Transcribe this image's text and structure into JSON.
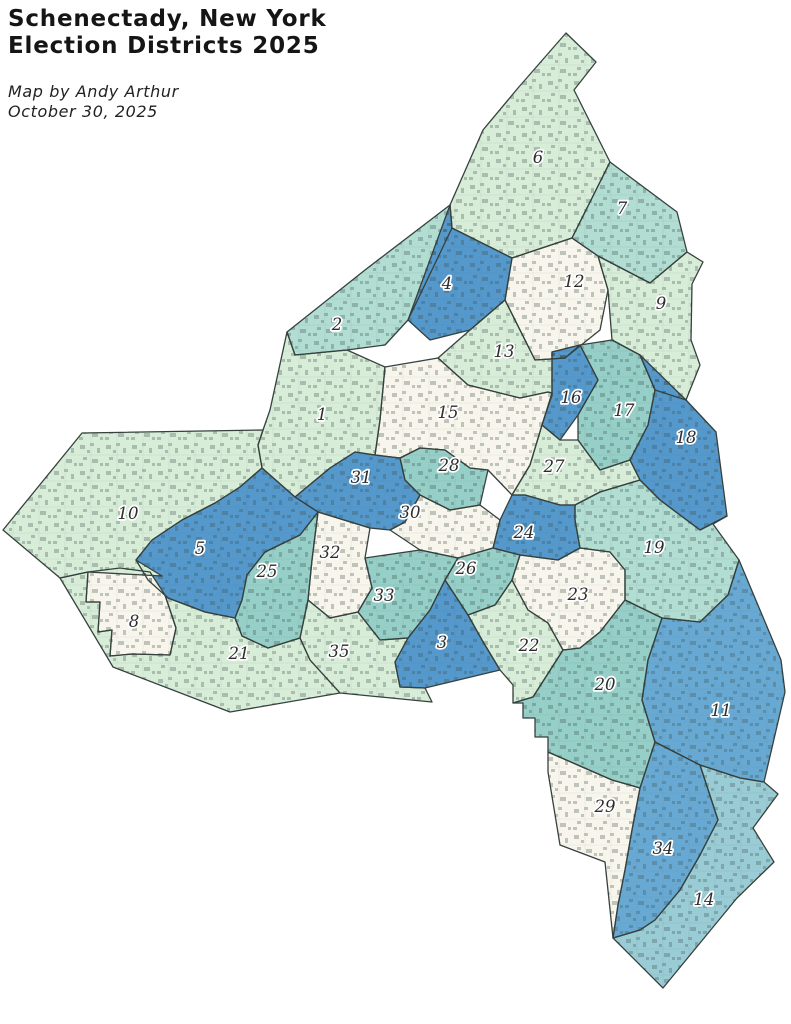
{
  "title": {
    "text": "Schenectady, New York\nElection Districts 2025"
  },
  "credit": {
    "text": "Map by Andy Arthur\nOctober 30, 2025"
  },
  "map": {
    "stroke_color": "#36413e",
    "building_mark_color": "#3c4f4b",
    "palette": {
      "pale_green": "#d7edd8",
      "teal_light": "#b2ddd2",
      "teal": "#96cfc7",
      "blue": "#5598cb",
      "blue_medium": "#68a9d3",
      "blue_pale": "#9accd6",
      "cream": "#f8f6ec"
    },
    "districts": [
      {
        "number": "1",
        "fill": "pale_green",
        "label_x": 322,
        "label_y": 414,
        "points": "263,430 270,410 287,332 295,355 347,350 385,367 380,420 375,455 355,452 330,468 295,497 262,468 258,445"
      },
      {
        "number": "2",
        "fill": "teal_light",
        "label_x": 337,
        "label_y": 324,
        "points": "365,270 450,205 452,228 408,320 385,345 347,350 295,355 287,332"
      },
      {
        "number": "3",
        "fill": "blue",
        "label_x": 442,
        "label_y": 642,
        "points": "445,580 468,615 482,640 500,670 425,688 400,687 395,662 408,638 430,610"
      },
      {
        "number": "4",
        "fill": "blue",
        "label_x": 447,
        "label_y": 283,
        "points": "450,205 452,228 512,258 505,300 470,330 430,340 408,320"
      },
      {
        "number": "5",
        "fill": "blue",
        "label_x": 200,
        "label_y": 548,
        "points": "262,468 295,497 318,512 300,535 265,552 247,575 242,600 235,618 205,612 168,598 148,580 136,560 152,540 182,520 215,503 240,487"
      },
      {
        "number": "6",
        "fill": "pale_green",
        "label_x": 538,
        "label_y": 157,
        "points": "566,33 596,62 574,90 610,162 572,238 512,258 452,228 450,205 483,130 518,88"
      },
      {
        "number": "7",
        "fill": "teal_light",
        "label_x": 622,
        "label_y": 208,
        "points": "610,162 677,212 687,252 650,283 598,256 572,238"
      },
      {
        "number": "8",
        "fill": "cream",
        "label_x": 134,
        "label_y": 621,
        "points": "88,572 120,568 150,572 165,595 176,628 170,655 132,654 110,656 112,630 98,632 100,602 86,602"
      },
      {
        "number": "9",
        "fill": "pale_green",
        "label_x": 661,
        "label_y": 303,
        "points": "598,256 650,283 687,252 703,262 692,284 691,340 700,365 686,400 655,390 640,355 612,340 608,290"
      },
      {
        "number": "10",
        "fill": "pale_green",
        "label_x": 128,
        "label_y": 513,
        "points": "3,530 82,433 263,430 258,445 262,468 240,487 215,503 182,520 152,540 136,560 162,576 88,572 60,578"
      },
      {
        "number": "11",
        "fill": "blue_medium",
        "label_x": 721,
        "label_y": 710,
        "points": "728,595 739,560 781,660 785,692 764,782 740,778 700,765 655,742 642,700 648,660 662,618 700,622"
      },
      {
        "number": "12",
        "fill": "cream",
        "label_x": 574,
        "label_y": 281,
        "points": "512,258 572,238 598,256 608,290 600,330 565,358 535,360 505,300"
      },
      {
        "number": "13",
        "fill": "pale_green",
        "label_x": 504,
        "label_y": 351,
        "points": "438,358 470,330 505,300 535,360 565,358 580,345 552,352 552,393 548,392 520,398 468,385"
      },
      {
        "number": "14",
        "fill": "blue_pale",
        "label_x": 704,
        "label_y": 899,
        "points": "700,765 740,778 764,782 778,794 753,828 774,862 737,898 663,988 613,938 640,930 655,920 680,890 700,855 718,820"
      },
      {
        "number": "15",
        "fill": "cream",
        "label_x": 448,
        "label_y": 412,
        "points": "385,367 438,358 468,385 520,398 548,392 552,393 542,425 530,465 512,495 488,470 470,468 445,450 420,448 400,458 375,455 380,420"
      },
      {
        "number": "16",
        "fill": "blue",
        "label_x": 571,
        "label_y": 397,
        "points": "552,352 580,345 598,380 578,415 560,440 542,425 552,395"
      },
      {
        "number": "17",
        "fill": "teal",
        "label_x": 624,
        "label_y": 410,
        "points": "580,345 612,340 640,355 655,390 648,425 630,460 600,470 578,440 578,415 598,380"
      },
      {
        "number": "18",
        "fill": "blue",
        "label_x": 686,
        "label_y": 437,
        "points": "640,355 686,400 716,432 727,516 700,530 660,500 640,480 630,460 648,425 655,390"
      },
      {
        "number": "19",
        "fill": "teal_light",
        "label_x": 654,
        "label_y": 547,
        "points": "575,505 600,492 640,480 660,500 700,530 727,516 713,524 739,560 728,595 700,622 662,618 625,600 625,570 610,552 580,548 575,520"
      },
      {
        "number": "20",
        "fill": "teal",
        "label_x": 605,
        "label_y": 684,
        "points": "533,697 563,650 580,648 600,632 625,600 662,618 648,660 642,700 655,742 640,788 612,780 580,766 548,752 548,737 535,737 535,718 523,718 523,703 513,703"
      },
      {
        "number": "21",
        "fill": "pale_green",
        "label_x": 239,
        "label_y": 653,
        "points": "60,578 88,572 86,602 100,602 98,632 112,630 110,656 132,654 170,655 176,628 165,595 168,598 205,612 235,618 242,636 268,648 300,638 310,660 340,693 230,712 113,667"
      },
      {
        "number": "22",
        "fill": "pale_green",
        "label_x": 529,
        "label_y": 645,
        "points": "468,615 495,605 512,580 528,610 548,623 563,650 533,697 513,703 513,685 500,670 482,640"
      },
      {
        "number": "23",
        "fill": "cream",
        "label_x": 578,
        "label_y": 594,
        "points": "512,580 520,555 558,560 580,548 610,552 625,570 625,600 600,632 580,648 563,650 548,623 528,610"
      },
      {
        "number": "24",
        "fill": "blue",
        "label_x": 524,
        "label_y": 532,
        "points": "500,520 512,495 525,495 560,505 575,505 575,520 580,548 558,560 520,555 493,548"
      },
      {
        "number": "25",
        "fill": "teal",
        "label_x": 267,
        "label_y": 571,
        "points": "318,512 312,560 308,600 300,638 268,648 242,636 235,618 242,600 247,575 265,552 300,535"
      },
      {
        "number": "26",
        "fill": "teal",
        "label_x": 466,
        "label_y": 568,
        "points": "458,558 493,548 520,555 512,580 495,605 468,615 445,580"
      },
      {
        "number": "27",
        "fill": "pale_green",
        "label_x": 554,
        "label_y": 466,
        "points": "512,495 530,465 542,425 560,440 578,440 600,470 630,460 640,480 600,492 575,505 560,505 525,495"
      },
      {
        "number": "28",
        "fill": "teal",
        "label_x": 449,
        "label_y": 465,
        "points": "400,458 420,448 445,450 470,468 488,470 480,505 450,510 420,495 405,480"
      },
      {
        "number": "29",
        "fill": "cream",
        "label_x": 605,
        "label_y": 806,
        "points": "548,752 580,766 612,780 640,788 632,830 625,870 618,905 613,938 605,862 560,845 548,772"
      },
      {
        "number": "30",
        "fill": "cream",
        "label_x": 410,
        "label_y": 512,
        "points": "390,530 405,522 420,495 450,510 480,505 500,520 493,548 458,558 420,550"
      },
      {
        "number": "31",
        "fill": "blue",
        "label_x": 361,
        "label_y": 477,
        "points": "375,455 400,458 405,480 420,495 405,522 390,530 370,528 318,512 295,497 330,468 355,452"
      },
      {
        "number": "32",
        "fill": "cream",
        "label_x": 330,
        "label_y": 552,
        "points": "318,512 370,528 365,558 372,588 358,612 330,618 308,600 312,560"
      },
      {
        "number": "33",
        "fill": "teal",
        "label_x": 384,
        "label_y": 595,
        "points": "365,558 420,550 458,558 445,580 430,610 408,638 380,640 358,612 372,588"
      },
      {
        "number": "34",
        "fill": "blue_medium",
        "label_x": 663,
        "label_y": 848,
        "points": "640,788 655,742 700,765 718,820 700,855 680,890 655,920 640,930 613,938 618,905 625,870 632,830"
      },
      {
        "number": "35",
        "fill": "pale_green",
        "label_x": 339,
        "label_y": 651,
        "points": "308,600 330,618 358,612 380,640 408,638 395,662 400,687 425,688 432,702 340,693 310,660 300,638"
      }
    ]
  }
}
